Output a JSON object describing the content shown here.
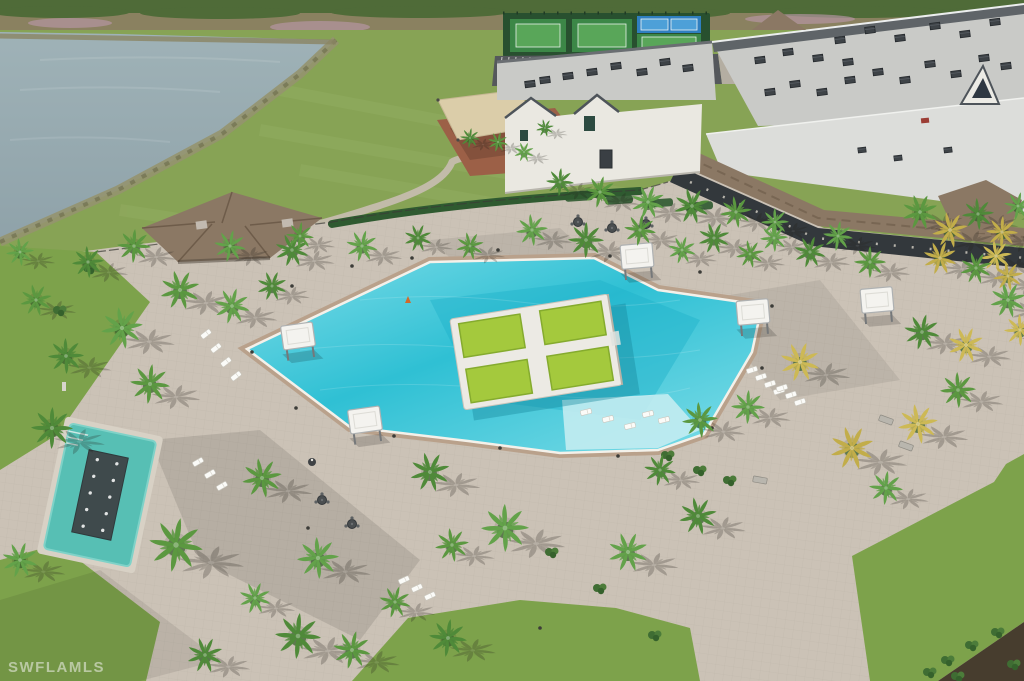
{
  "watermark": {
    "text": "SWFLAMLS"
  },
  "palette": {
    "scrub": "#8a8160",
    "treeline": "#4f6b38",
    "pink": "#b897a8",
    "grass": "#87a355",
    "grassLight": "#9ab46a",
    "lawn": "#7da24b",
    "lake": "#8fa2a9",
    "shore": "#95946f",
    "deck": "#cbc2b6",
    "deckShadow": "#5a544c",
    "poolWater": "#2fc0d4",
    "poolEdge": "#7fdde8",
    "poolDeep": "#1fb2c9",
    "poolShallow": "#c3ecf1",
    "coping": "#f4f1ea",
    "surround": "#b9a18b",
    "islandDeck": "#eceae4",
    "padGreen": "#a4c93d",
    "padGreenDark": "#85ab2e",
    "roofLight": "#c9cac7",
    "roofLower": "#dcddda",
    "fascia": "#5f6468",
    "wall": "#eae8e1",
    "gableTrim": "#4e545a",
    "shingle": "#8b7864",
    "openings": "#33383c",
    "hvac": "#3e4347",
    "courtBase": "#28502f",
    "courtGreen": "#3c8747",
    "courtGreenIn": "#59a659",
    "courtBlue": "#2f7fc0",
    "courtBlueIn": "#4da0d8",
    "asphalt": "#55585c",
    "stripe": "#e8e8e4",
    "mulchPlay": "#9c6047",
    "sail": "#dbcda9",
    "hedge": "#2f5a30",
    "shrub": "#3f6d33",
    "palmGreens": [
      "#4f8a39",
      "#5b9840",
      "#63a24a"
    ],
    "palmGolds": [
      "#c2ad4a",
      "#cdb955"
    ],
    "spaWater": "#57bfb4",
    "spaFeature": "#3f4a4c",
    "cabanaTop": "#f4f3ef",
    "lounger": "#fbfbf8",
    "mulchDark": "#473d2e"
  },
  "scene": {
    "palms": [
      [
        88,
        262,
        0.8,
        0
      ],
      [
        134,
        246,
        0.85,
        0
      ],
      [
        230,
        246,
        0.8,
        0
      ],
      [
        292,
        250,
        0.85,
        0
      ],
      [
        180,
        290,
        1.0,
        0
      ],
      [
        122,
        328,
        1.05,
        0
      ],
      [
        66,
        356,
        0.9,
        0
      ],
      [
        150,
        384,
        1.0,
        0
      ],
      [
        232,
        306,
        0.9,
        0
      ],
      [
        272,
        286,
        0.75,
        0
      ],
      [
        36,
        300,
        0.8,
        0
      ],
      [
        20,
        252,
        0.7,
        0
      ],
      [
        52,
        428,
        1.05,
        0
      ],
      [
        176,
        545,
        1.35,
        0
      ],
      [
        20,
        560,
        0.9,
        0
      ],
      [
        205,
        655,
        0.9,
        0
      ],
      [
        262,
        478,
        1.0,
        0
      ],
      [
        318,
        558,
        1.05,
        0
      ],
      [
        298,
        636,
        1.15,
        0
      ],
      [
        352,
        650,
        0.95,
        0
      ],
      [
        255,
        598,
        0.8,
        0
      ],
      [
        430,
        472,
        1.0,
        0
      ],
      [
        452,
        545,
        0.85,
        0
      ],
      [
        505,
        528,
        1.2,
        0
      ],
      [
        448,
        638,
        0.95,
        0
      ],
      [
        395,
        602,
        0.8,
        0
      ],
      [
        628,
        552,
        1.0,
        0
      ],
      [
        698,
        516,
        0.95,
        0
      ],
      [
        700,
        420,
        0.9,
        0
      ],
      [
        748,
        407,
        0.85,
        0
      ],
      [
        660,
        470,
        0.8,
        0
      ],
      [
        800,
        362,
        1.0,
        1
      ],
      [
        852,
        448,
        1.1,
        1
      ],
      [
        918,
        424,
        1.0,
        1
      ],
      [
        958,
        390,
        0.9,
        0
      ],
      [
        886,
        488,
        0.85,
        0
      ],
      [
        922,
        332,
        0.9,
        0
      ],
      [
        966,
        345,
        0.9,
        1
      ],
      [
        1008,
        300,
        0.9,
        0
      ],
      [
        996,
        256,
        0.8,
        1
      ],
      [
        870,
        262,
        0.8,
        0
      ],
      [
        838,
        236,
        0.75,
        0
      ],
      [
        810,
        252,
        0.8,
        0
      ],
      [
        920,
        212,
        0.9,
        0
      ],
      [
        950,
        230,
        0.9,
        1
      ],
      [
        978,
        214,
        0.8,
        0
      ],
      [
        1002,
        232,
        0.8,
        1
      ],
      [
        1018,
        206,
        0.7,
        0
      ],
      [
        940,
        258,
        0.85,
        1
      ],
      [
        976,
        268,
        0.8,
        0
      ],
      [
        1008,
        276,
        0.75,
        1
      ],
      [
        1020,
        330,
        0.8,
        1
      ],
      [
        300,
        236,
        0.7,
        0
      ],
      [
        362,
        246,
        0.8,
        0
      ],
      [
        418,
        238,
        0.7,
        0
      ],
      [
        470,
        246,
        0.7,
        0
      ],
      [
        532,
        230,
        0.8,
        0
      ],
      [
        586,
        240,
        0.9,
        0
      ],
      [
        640,
        230,
        0.8,
        0
      ],
      [
        682,
        250,
        0.7,
        0
      ],
      [
        714,
        238,
        0.8,
        0
      ],
      [
        750,
        254,
        0.7,
        0
      ],
      [
        774,
        238,
        0.7,
        0
      ],
      [
        560,
        182,
        0.7,
        0
      ],
      [
        600,
        192,
        0.8,
        0
      ],
      [
        648,
        202,
        0.85,
        0
      ],
      [
        692,
        206,
        0.9,
        0
      ],
      [
        736,
        212,
        0.8,
        0
      ],
      [
        775,
        222,
        0.7,
        0
      ],
      [
        470,
        138,
        0.5,
        0
      ],
      [
        498,
        142,
        0.5,
        0
      ],
      [
        524,
        152,
        0.5,
        0
      ],
      [
        545,
        128,
        0.45,
        0
      ]
    ],
    "cabanas": [
      [
        298,
        336,
        -8
      ],
      [
        365,
        420,
        -8
      ],
      [
        637,
        256,
        -5
      ],
      [
        753,
        312,
        -5
      ],
      [
        877,
        300,
        -5
      ]
    ],
    "loungerRows": [
      {
        "x": 206,
        "y": 334,
        "n": 4,
        "dx": 10,
        "dy": 14,
        "rot": -38
      },
      {
        "x": 198,
        "y": 462,
        "n": 3,
        "dx": 12,
        "dy": 12,
        "rot": -30
      },
      {
        "x": 752,
        "y": 370,
        "n": 4,
        "dx": 9,
        "dy": 7,
        "rot": -18
      },
      {
        "x": 782,
        "y": 388,
        "n": 3,
        "dx": 9,
        "dy": 7,
        "rot": -18
      },
      {
        "x": 586,
        "y": 412,
        "n": 3,
        "dx": 22,
        "dy": 7,
        "rot": -14
      },
      {
        "x": 404,
        "y": 580,
        "n": 3,
        "dx": 13,
        "dy": 8,
        "rot": -25
      },
      {
        "x": 648,
        "y": 414,
        "n": 2,
        "dx": 16,
        "dy": 6,
        "rot": -14
      }
    ],
    "hvac": {
      "main": [
        [
          770,
          92
        ],
        [
          795,
          84
        ],
        [
          822,
          92
        ],
        [
          850,
          80
        ],
        [
          878,
          72
        ],
        [
          905,
          80
        ],
        [
          930,
          64
        ],
        [
          956,
          74
        ],
        [
          984,
          58
        ],
        [
          1006,
          66
        ],
        [
          840,
          40
        ],
        [
          870,
          30
        ],
        [
          900,
          38
        ],
        [
          935,
          26
        ],
        [
          965,
          34
        ],
        [
          995,
          22
        ],
        [
          760,
          60
        ],
        [
          788,
          52
        ],
        [
          818,
          58
        ],
        [
          848,
          62
        ]
      ],
      "wing": [
        [
          592,
          72
        ],
        [
          616,
          66
        ],
        [
          642,
          72
        ],
        [
          665,
          62
        ],
        [
          688,
          68
        ],
        [
          545,
          80
        ],
        [
          568,
          76
        ],
        [
          530,
          84
        ]
      ],
      "lower": [
        [
          862,
          150
        ],
        [
          898,
          158
        ],
        [
          948,
          150
        ]
      ]
    },
    "bollards": [
      [
        292,
        286
      ],
      [
        352,
        266
      ],
      [
        412,
        258
      ],
      [
        498,
        250
      ],
      [
        610,
        256
      ],
      [
        700,
        272
      ],
      [
        772,
        306
      ],
      [
        762,
        368
      ],
      [
        712,
        428
      ],
      [
        618,
        456
      ],
      [
        500,
        448
      ],
      [
        394,
        436
      ],
      [
        296,
        408
      ],
      [
        252,
        352
      ],
      [
        540,
        628
      ],
      [
        308,
        528
      ]
    ],
    "tables": [
      [
        578,
        222
      ],
      [
        612,
        228
      ],
      [
        646,
        224
      ],
      [
        322,
        500
      ],
      [
        352,
        524
      ]
    ],
    "benches": [
      [
        886,
        420,
        20
      ],
      [
        906,
        446,
        20
      ],
      [
        760,
        480,
        10
      ]
    ],
    "shrubs": [
      [
        552,
        552
      ],
      [
        668,
        455
      ],
      [
        700,
        470
      ],
      [
        730,
        480
      ],
      [
        600,
        588
      ],
      [
        655,
        635
      ],
      [
        948,
        660
      ],
      [
        972,
        645
      ],
      [
        998,
        632
      ],
      [
        1014,
        664
      ],
      [
        930,
        672
      ],
      [
        958,
        676
      ],
      [
        90,
        268
      ],
      [
        60,
        310
      ]
    ],
    "parkingStripes": {
      "x0": 502,
      "x1": 712,
      "step": 7,
      "rows": [
        [
          57,
          69
        ],
        [
          73,
          84
        ]
      ]
    }
  }
}
